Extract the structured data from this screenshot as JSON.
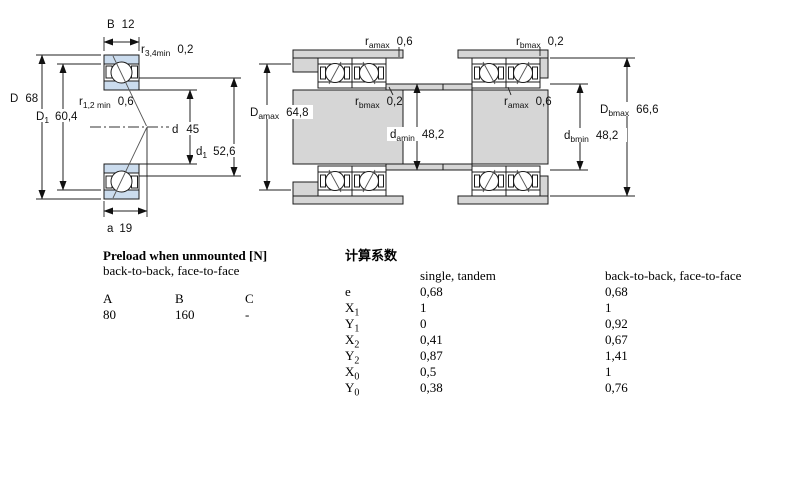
{
  "colors": {
    "ring_blue": "#cbdcee",
    "metal_gray": "#d6d6d6"
  },
  "fig_left": {
    "B": {
      "base": "B",
      "value": "12"
    },
    "r34": {
      "base": "r",
      "sub": "3,4min",
      "value": "0,2"
    },
    "D": {
      "base": "D",
      "value": "68"
    },
    "D1": {
      "base": "D",
      "sub": "1",
      "value": "60,4"
    },
    "r12": {
      "base": "r",
      "sub": "1,2 min",
      "value": "0,6"
    },
    "d": {
      "base": "d",
      "value": "45"
    },
    "d1": {
      "base": "d",
      "sub": "1",
      "value": "52,6"
    },
    "a": {
      "base": "a",
      "value": "19"
    }
  },
  "fig_mid": {
    "ramax": {
      "base": "r",
      "sub": "amax",
      "value": "0,6"
    },
    "rbmax": {
      "base": "r",
      "sub": "bmax",
      "value": "0,2"
    },
    "Damax": {
      "base": "D",
      "sub": "amax",
      "value": "64,8"
    },
    "damin": {
      "base": "d",
      "sub": "amin",
      "value": "48,2"
    }
  },
  "fig_right": {
    "rbmax": {
      "base": "r",
      "sub": "bmax",
      "value": "0,2"
    },
    "ramax": {
      "base": "r",
      "sub": "amax",
      "value": "0,6"
    },
    "Dbmax": {
      "base": "D",
      "sub": "bmax",
      "value": "66,6"
    },
    "dbmin": {
      "base": "d",
      "sub": "bmin",
      "value": "48,2"
    }
  },
  "preload_table": {
    "title": "Preload when unmounted [N]",
    "subtitle": "back-to-back, face-to-face",
    "headers": [
      "A",
      "B",
      "C"
    ],
    "values": [
      "80",
      "160",
      "-"
    ]
  },
  "factors_table": {
    "title": "计算系数",
    "col1_header": "single, tandem",
    "col2_header": "back-to-back, face-to-face",
    "rows": [
      {
        "base": "e",
        "sub": "",
        "c1": "0,68",
        "c2": "0,68"
      },
      {
        "base": "X",
        "sub": "1",
        "c1": "1",
        "c2": "1"
      },
      {
        "base": "Y",
        "sub": "1",
        "c1": "0",
        "c2": "0,92"
      },
      {
        "base": "X",
        "sub": "2",
        "c1": "0,41",
        "c2": "0,67"
      },
      {
        "base": "Y",
        "sub": "2",
        "c1": "0,87",
        "c2": "1,41"
      },
      {
        "base": "X",
        "sub": "0",
        "c1": "0,5",
        "c2": "1"
      },
      {
        "base": "Y",
        "sub": "0",
        "c1": "0,38",
        "c2": "0,76"
      }
    ]
  }
}
